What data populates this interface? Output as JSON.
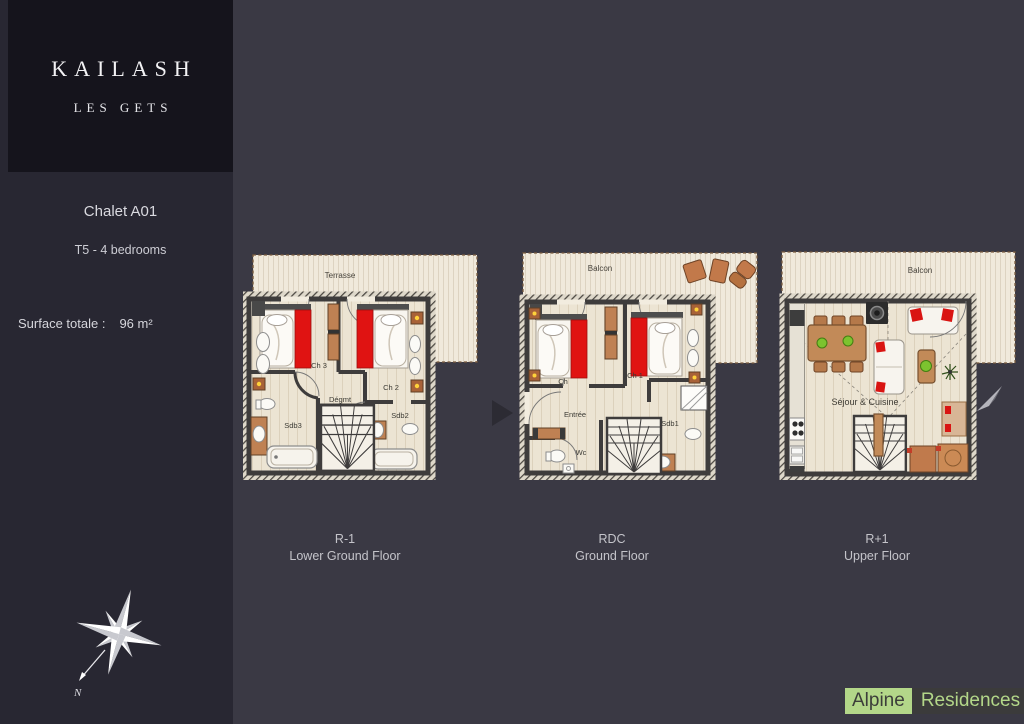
{
  "brand": {
    "title": "KAILASH",
    "subtitle": "LES GETS"
  },
  "sidebar": {
    "chalet_name": "Chalet A01",
    "unit_type": "T5 - 4 bedrooms",
    "surface_label": "Surface totale :",
    "surface_value": "96 m²"
  },
  "plans": [
    {
      "code": "R-1",
      "name": "Lower Ground Floor",
      "outdoor_label": "Terrasse",
      "rooms": {
        "ch3": "Ch 3",
        "ch2": "Ch 2",
        "degmt": "Dégmt",
        "sdb3": "Sdb3",
        "sdb2": "Sdb2"
      }
    },
    {
      "code": "RDC",
      "name": "Ground Floor",
      "outdoor_label": "Balcon",
      "rooms": {
        "ch": "Ch",
        "ch1": "Ch 1",
        "entree": "Entrée",
        "sdb1": "Sdb1",
        "wc": "Wc"
      }
    },
    {
      "code": "R+1",
      "name": "Upper Floor",
      "outdoor_label": "Balcon",
      "rooms": {
        "sejour": "Séjour & Cuisine"
      }
    }
  ],
  "compass": {
    "north_label": "N"
  },
  "logo": {
    "name_first": "Alpine",
    "name_second": "Residences"
  },
  "colors": {
    "background": "#3a3944",
    "sidebar": "#282732",
    "brand_box": "#15141c",
    "bed_red": "#e01312",
    "logo_green": "#b3d789",
    "logo_dark": "#3b3b3b"
  }
}
